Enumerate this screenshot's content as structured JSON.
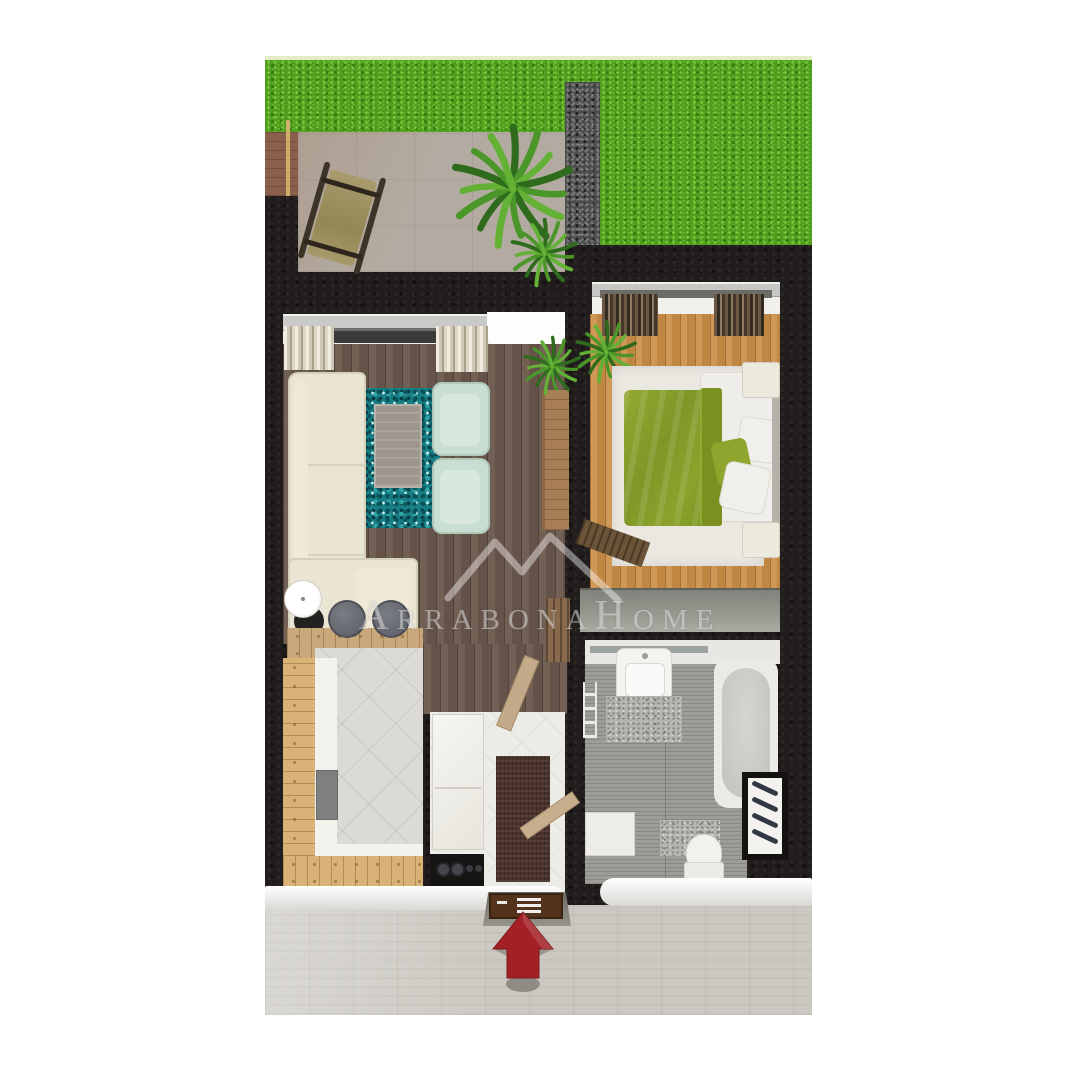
{
  "watermark": {
    "text": "ArrabonaHome",
    "logo": "mountain-peaks-icon"
  },
  "entrance_arrow": {
    "icon": "up-arrow",
    "color": "#a32025",
    "direction": "up"
  },
  "palette": {
    "background": "#ffffff",
    "grass": "#4f9d1d",
    "gravel_path": "#4c4c4a",
    "wall": "#201d1c",
    "terrace_stone": "#b3aba1",
    "living_floor": "#6b574c",
    "bedroom_floor": "#c98e46",
    "kitchen_tile": "#dbdad4",
    "bathroom_tile": "#9d9c97",
    "corridor_tile": "#cbc8c1",
    "entry_tile": "#ecebe5",
    "rug_teal": "#177e86",
    "sofa_cream": "#eae4d2",
    "armchair_mint": "#c9ded3",
    "duvet_green": "#849b28",
    "front_door_brown": "#54331c"
  }
}
